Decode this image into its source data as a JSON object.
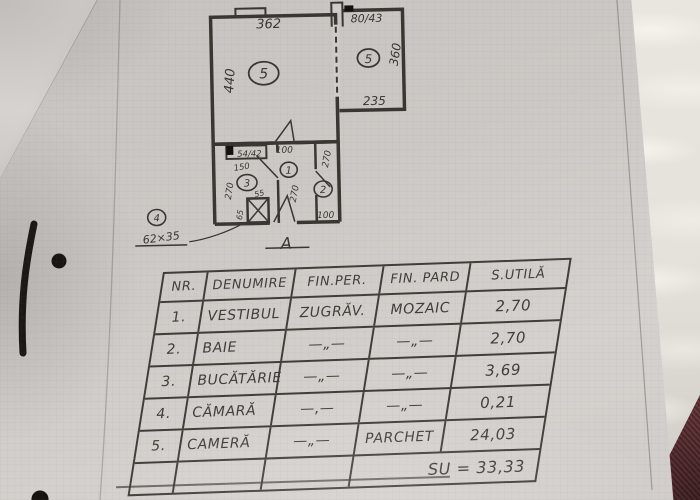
{
  "photo": {
    "ink_color": "#433d38",
    "paper_color": "#ccc8c5",
    "fur_color": "#e9e6df",
    "fabric_color": "#5b2f32"
  },
  "floor_plan": {
    "main_room": {
      "badge": "5",
      "dim_top": "362",
      "dim_left": "440"
    },
    "right_room": {
      "badge": "5",
      "dim_top": "80/43",
      "dim_right": "360",
      "dim_bottom": "235"
    },
    "kitchen": {
      "badge": "3",
      "window": "54/42",
      "dim_door": "150",
      "dim_left": "270",
      "dim_shaft": "55",
      "dim_fixture": "65"
    },
    "vestibule": {
      "badge": "1",
      "dim_top": "100",
      "dim_height": "270"
    },
    "bathroom": {
      "badge": "2",
      "dim_height": "270",
      "dim_bottom": "100"
    },
    "pantry": {
      "badge": "4",
      "size": "62×35"
    },
    "section_marker": "A"
  },
  "table": {
    "headers": [
      "NR.",
      "DENUMIRE",
      "FIN.PER.",
      "FIN. PARD",
      "S.UTILĂ"
    ],
    "rows": [
      [
        "1.",
        "VESTIBUL",
        "ZUGRĂV.",
        "MOZAIC",
        "2,70"
      ],
      [
        "2.",
        "BAIE",
        "—„—",
        "—„—",
        "2,70"
      ],
      [
        "3.",
        "BUCĂTĂRIE",
        "—„—",
        "—„—",
        "3,69"
      ],
      [
        "4.",
        "CĂMARĂ",
        "—,—",
        "—„—",
        "0,21"
      ],
      [
        "5.",
        "CAMERĂ",
        "—„—",
        "PARCHET",
        "24,03"
      ]
    ],
    "total": "SU = 33,33"
  }
}
